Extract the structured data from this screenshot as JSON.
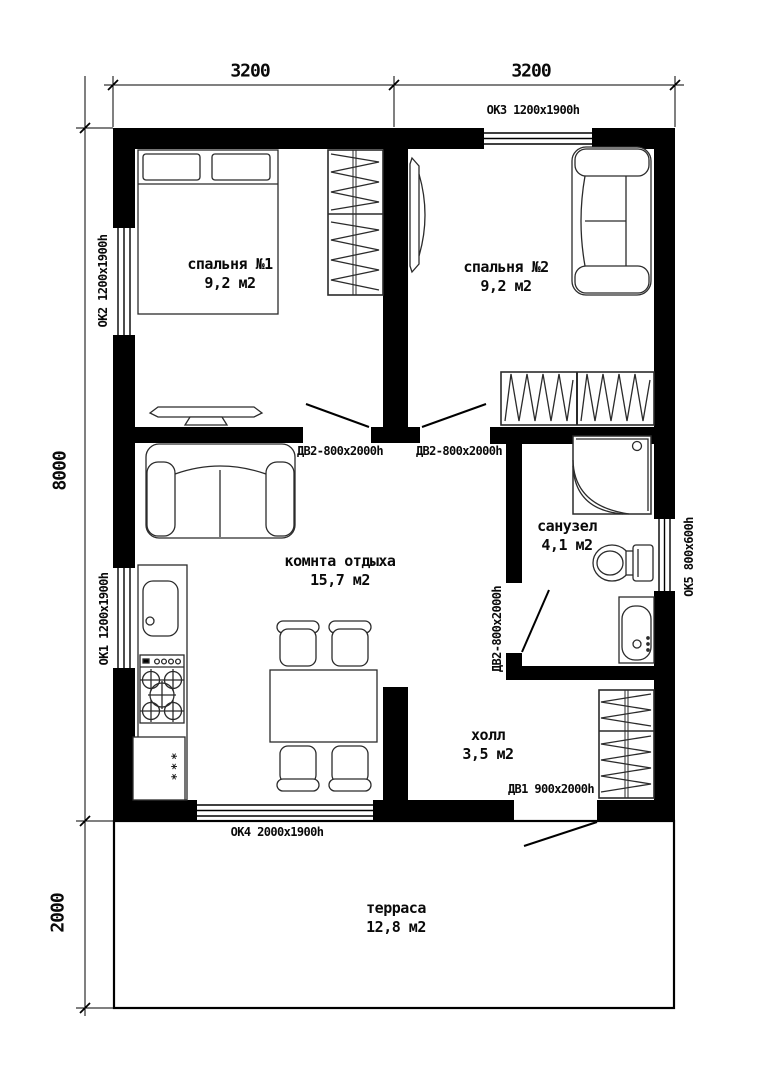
{
  "dimensions": {
    "top_left": "3200",
    "top_right": "3200",
    "side_height": "8000",
    "side_terrace": "2000"
  },
  "rooms": {
    "bedroom1": {
      "name": "спальня №1",
      "area": "9,2 м2"
    },
    "bedroom2": {
      "name": "спальня №2",
      "area": "9,2 м2"
    },
    "lounge": {
      "name": "комнта отдыха",
      "area": "15,7 м2"
    },
    "bathroom": {
      "name": "санузел",
      "area": "4,1 м2"
    },
    "hall": {
      "name": "холл",
      "area": "3,5 м2"
    },
    "terrace": {
      "name": "терраса",
      "area": "12,8 м2"
    }
  },
  "windows": {
    "ok1": {
      "label": "ОК1 1200x1900h"
    },
    "ok2": {
      "label": "ОК2 1200x1900h"
    },
    "ok3": {
      "label": "ОК3 1200x1900h"
    },
    "ok4": {
      "label": "ОК4 2000x1900h"
    },
    "ok5": {
      "label": "ОК5 800x600h"
    }
  },
  "doors": {
    "dv2_bedroom1": {
      "label": "ДВ2-800x2000h"
    },
    "dv2_bedroom2": {
      "label": "ДВ2-800x2000h"
    },
    "dv2_bathroom": {
      "label": "ДВ2-800x2000h"
    },
    "dv1_entrance": {
      "label": "ДВ1 900x2000h"
    }
  },
  "symbols": {
    "fridge": "***"
  }
}
